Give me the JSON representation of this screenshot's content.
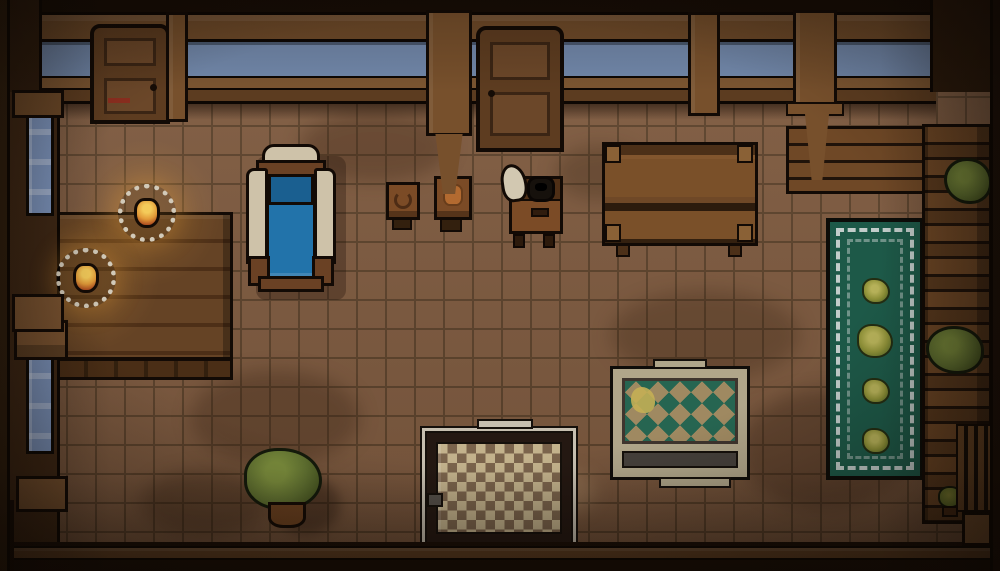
{
  "scene": {
    "description": "pixel-art top-down tavern room interior",
    "view": "top-down",
    "objects": [
      "wooden-door-left",
      "wooden-door-center",
      "balustrade-with-sky-gaps",
      "left-wall-window-upper",
      "left-wall-window-lower",
      "dining-table",
      "bench",
      "candle-on-plate-1",
      "candle-on-plate-2",
      "blue-armchair",
      "side-table-with-pot-1",
      "side-table-with-pot-2",
      "stove-with-cooking-pot",
      "flour-sack",
      "large-wooden-table",
      "green-runner-rug-with-plants",
      "diamond-pattern-rug",
      "checkered-rug",
      "potted-plant",
      "wall-shelf-top-right",
      "shelf-column-right",
      "shelf-bush-1",
      "shelf-bush-2",
      "small-plant-bottom-right",
      "tile-floor"
    ]
  },
  "palette": {
    "frame_dark": "#1c1008",
    "wood_beam": "#6e4a29",
    "wood_post": "#77502c",
    "wood_rail": "#7b5531",
    "wood_rail_dark": "#5c3c20",
    "wood_door": "#5d3c20",
    "wood_door_panel": "#6b4729",
    "sky_blue": "#7187a9",
    "floor_base": "#7f5b40",
    "floor_grout": "#5d432c",
    "wall_left": "#3f2815",
    "window_blue": "#7e96bf",
    "table_wood": "#654325",
    "bench_wood": "#7b5431",
    "plate_white": "#d2cab9",
    "flame_light": "#f4cb5a",
    "flame_mid": "#e29a38",
    "flame_dark": "#a8441d",
    "chair_cream": "#cec2a9",
    "chair_blue": "#2273aa",
    "chair_blue_dark": "#1a5f90",
    "chair_wood": "#6a4124",
    "stove_body": "#7b4b26",
    "stove_dark": "#4f2f16",
    "pot_black": "#16110c",
    "sack_white": "#d2c8b1",
    "bigtable_light": "#82562e",
    "bigtable_mid": "#6f4827",
    "rug_green": "#1d5948",
    "rug_trim": "#c2cdca",
    "plant_light": "#7a8c3c",
    "plant_green": "#5f7030",
    "plant_dark": "#42501e",
    "shelf_wood": "#6f4826",
    "shelf_line": "#20130a",
    "rug2_cream": "#b0a68a",
    "rug2_tan": "#9f8961",
    "rug2_green": "#266551",
    "rug2_gray": "#45403b",
    "rug2_yellow": "#c4af55",
    "rug3_cream": "#c3b28c",
    "rug3_brown": "#7b644c",
    "rug3_border": "#241812",
    "rug3_trim": "#c6bfb0",
    "pot_brown": "#6b4120",
    "bottom_beam": "#5e3e22"
  }
}
